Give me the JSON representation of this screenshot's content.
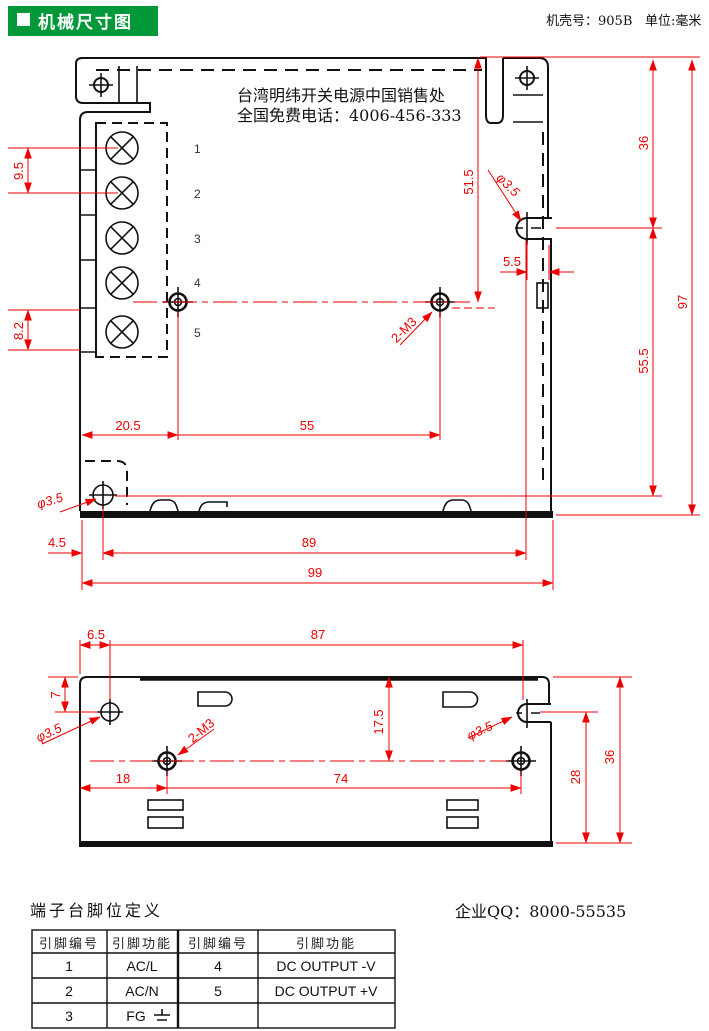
{
  "header": {
    "title": "机械尺寸图",
    "case_label": "机壳号：905B",
    "unit_label": "单位:毫米"
  },
  "top_view": {
    "note_line1": "台湾明纬开关电源中国销售处",
    "note_line2": "全国免费电话：4006-456-333",
    "terminals": [
      "1",
      "2",
      "3",
      "4",
      "5"
    ],
    "dims": {
      "pitch": "9.5",
      "bottom_pitch": "8.2",
      "hole_left": "20.5",
      "hole_span": "55",
      "top_to_holes": "51.5",
      "side_hole_dia": "φ3.5",
      "side_hole_edge": "5.5",
      "top_to_side_hole": "36",
      "side_hole_to_base_hole": "55.5",
      "height": "97",
      "base_hole_dia": "φ3.5",
      "base_hole_left": "4.5",
      "base_span": "89",
      "width": "99",
      "screws": "2-M3"
    }
  },
  "side_view": {
    "dims": {
      "edge_to_hole": "6.5",
      "hole_span_top": "87",
      "top_to_hole": "7",
      "hole_dia_left": "φ3.5",
      "screws": "2-M3",
      "top_to_center": "17.5",
      "hole_dia_right": "φ3.5",
      "left_to_m3": "18",
      "m3_span": "74",
      "hole_to_base": "28",
      "height": "36"
    }
  },
  "footer": {
    "table_title": "端子台脚位定义",
    "qq": "企业QQ：8000-55535"
  },
  "pin_table": {
    "headers": [
      "引脚编号",
      "引脚功能",
      "引脚编号",
      "引脚功能"
    ],
    "rows": [
      {
        "no": "1",
        "func": "AC/L",
        "no2": "4",
        "func2": "DC OUTPUT -V"
      },
      {
        "no": "2",
        "func": "AC/N",
        "no2": "5",
        "func2": "DC OUTPUT +V"
      },
      {
        "no": "3",
        "func": "FG",
        "no2": "",
        "func2": ""
      }
    ]
  },
  "colors": {
    "dimension_red": "#ee0000",
    "line_black": "#111111",
    "header_green": "#009838",
    "header_text": "#ffffff"
  }
}
